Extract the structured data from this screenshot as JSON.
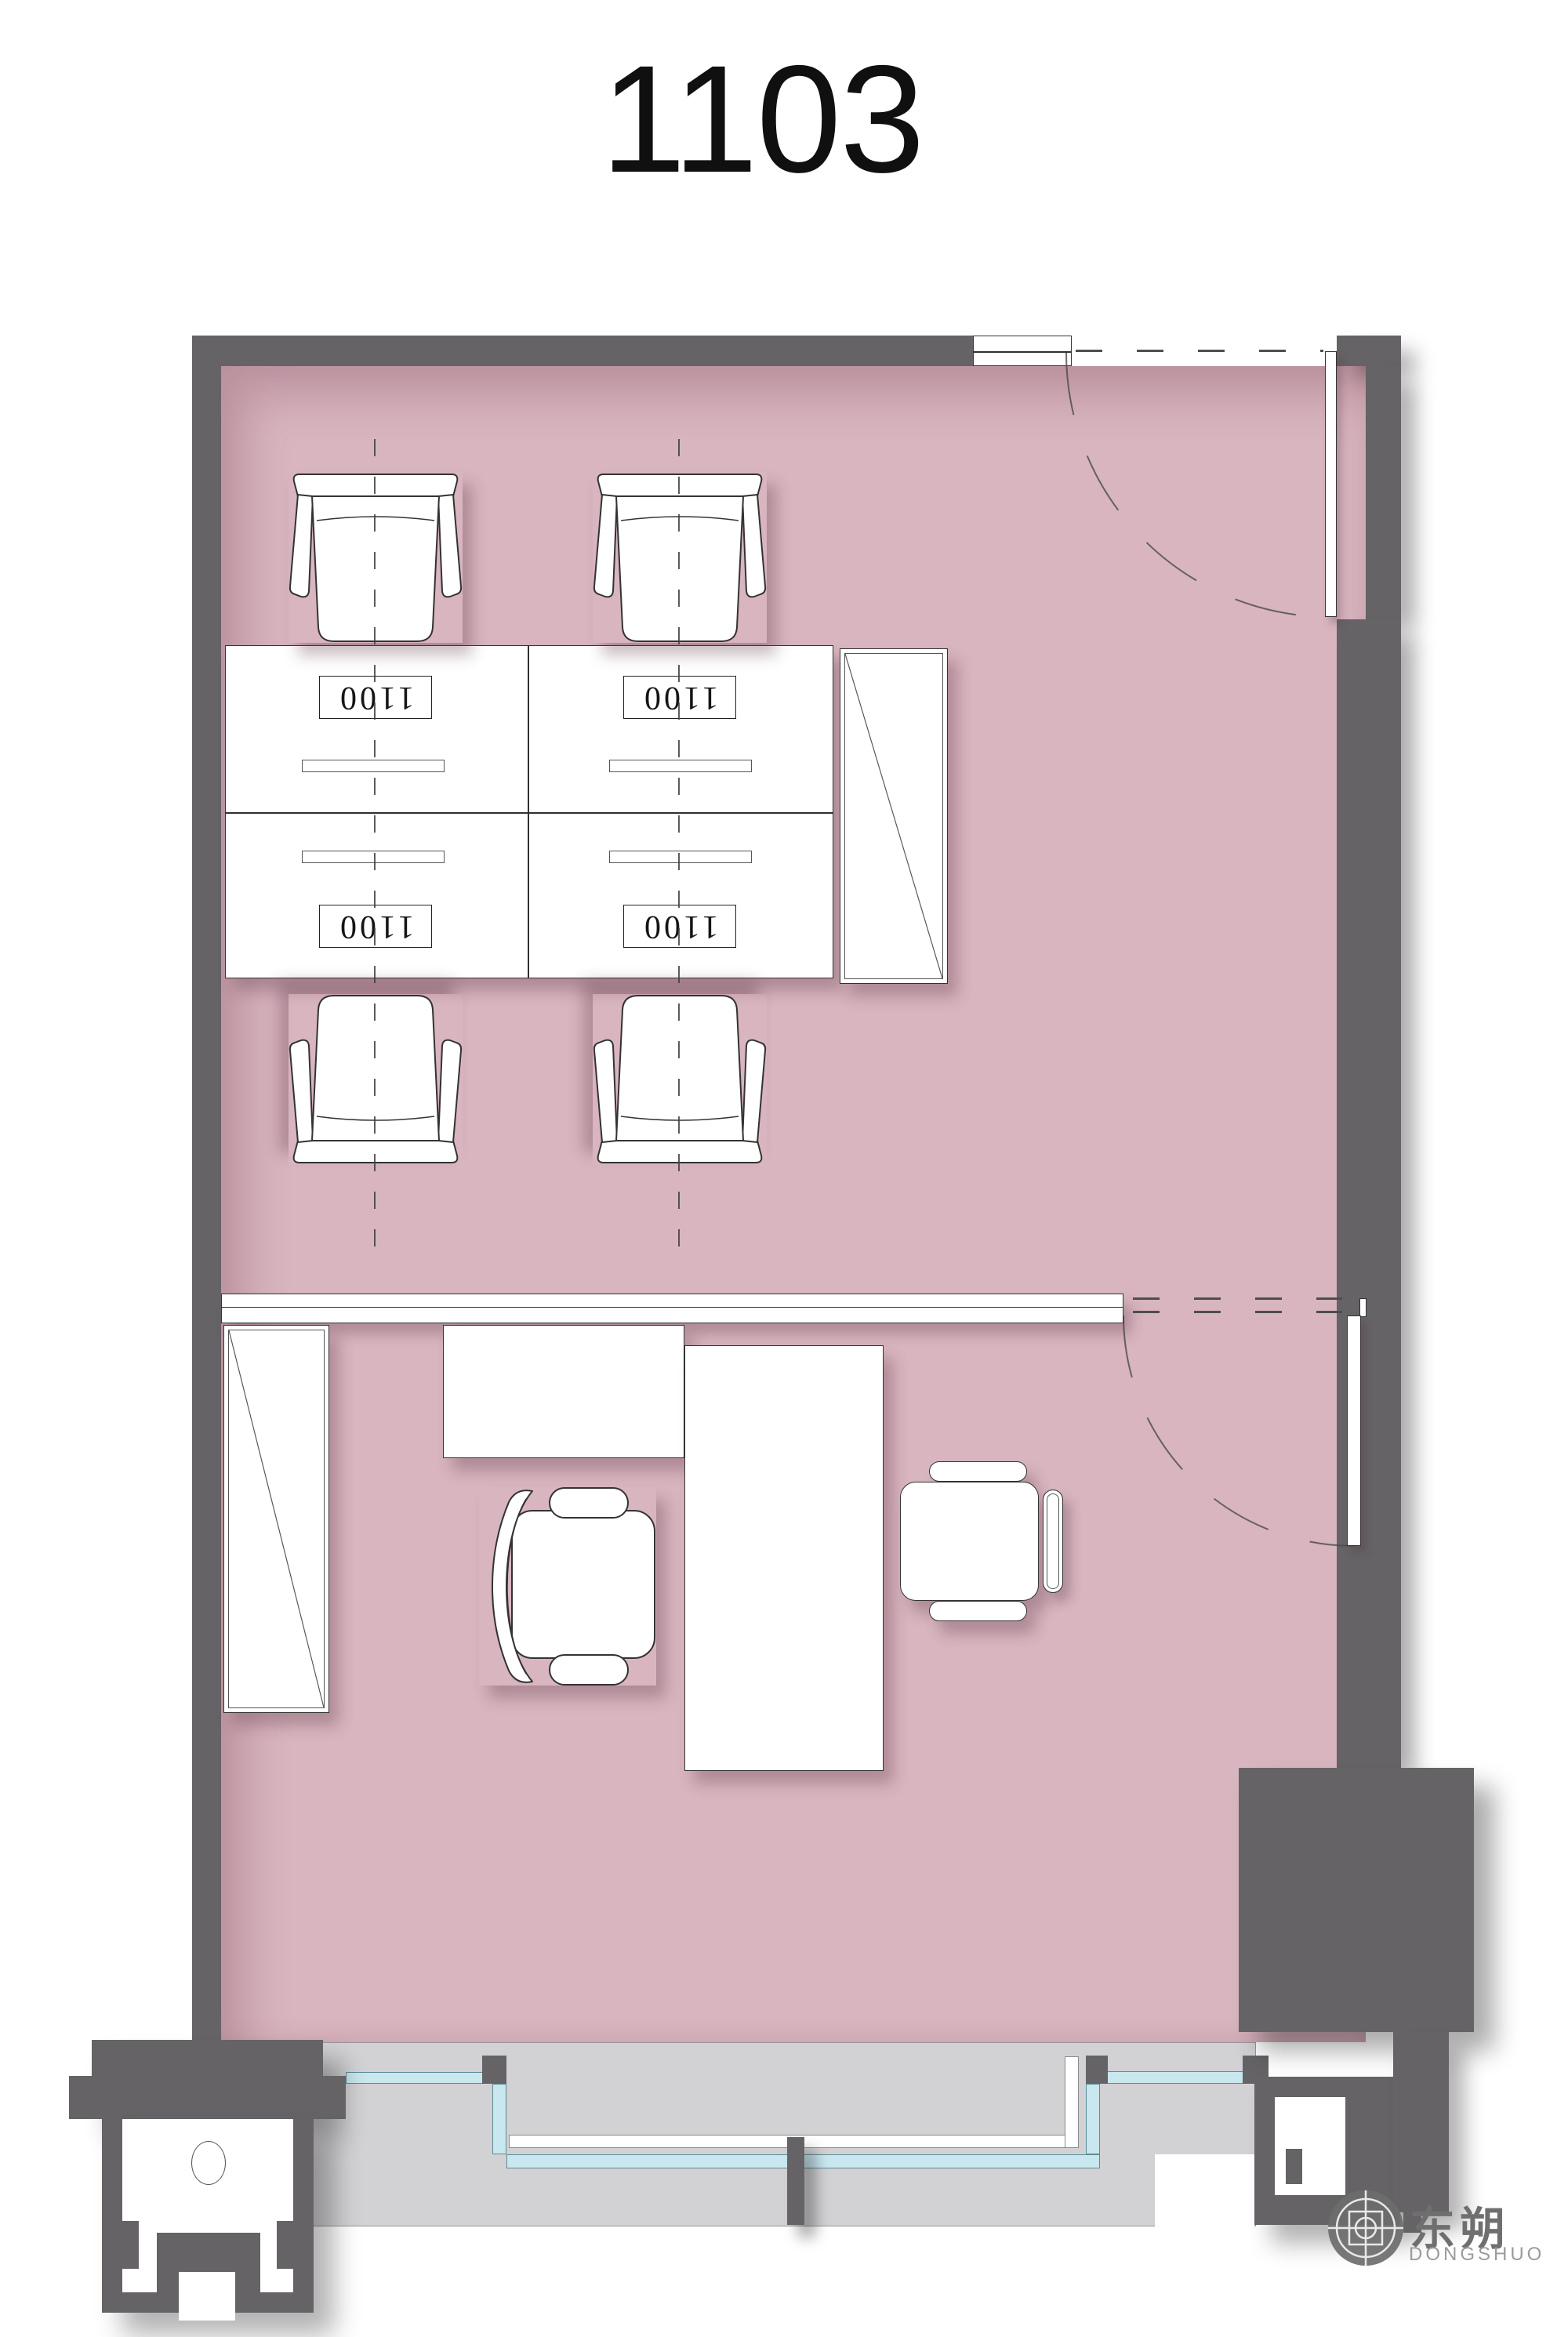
{
  "title": "1103",
  "desks": [
    {
      "label": "1100"
    },
    {
      "label": "1100"
    },
    {
      "label": "1100"
    },
    {
      "label": "1100"
    }
  ],
  "logo": {
    "cn": "东朔",
    "en": "DONGSHUO"
  },
  "colors": {
    "wall": "#656366",
    "floor": "#d8b5bf",
    "balcony": "#d2d1d3",
    "glass": "#c9e7ee",
    "glass_border": "#5d8d98",
    "outline": "#333333",
    "logo_gray": "#6f6f6f",
    "title_color": "#101010"
  }
}
